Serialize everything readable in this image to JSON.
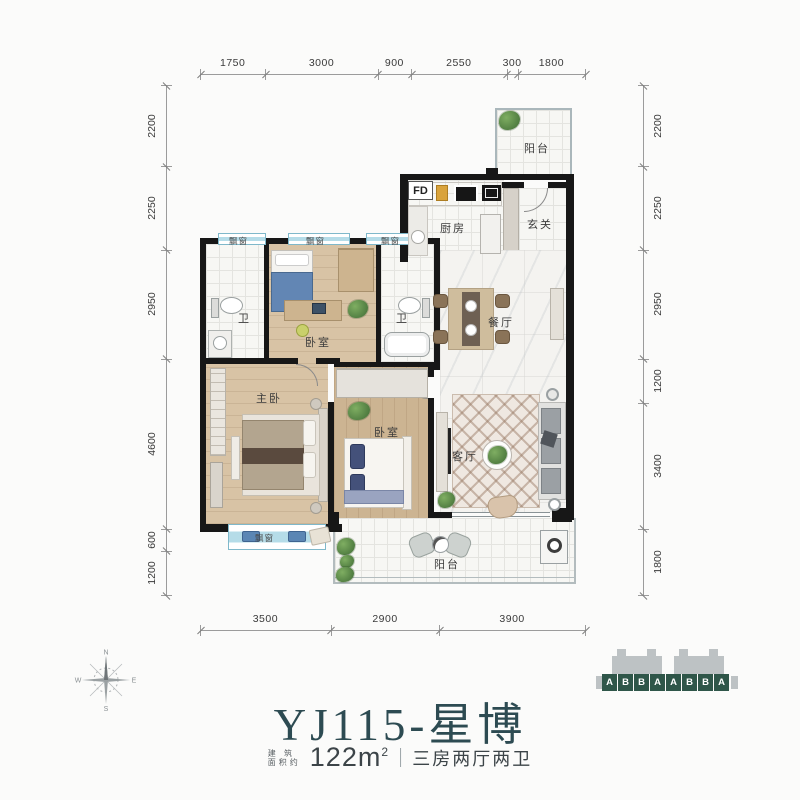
{
  "title_block": {
    "title": "YJ115-星博",
    "area_label_top": "建 筑",
    "area_label_bottom": "面积约",
    "area_value": "122m",
    "area_superscript": "2",
    "separator": "|",
    "spec": "三房两厅两卫"
  },
  "floorplan": {
    "rooms": {
      "balcony_top": "阳台",
      "flue": "FD",
      "kitchen": "厨房",
      "entry": "玄关",
      "dining": "餐厅",
      "bath_left": "卫",
      "bedroom_top": "卧室",
      "bath_right": "卫",
      "master": "主卧",
      "bedroom_second": "卧室",
      "living": "客厅",
      "balcony_bottom": "阳台",
      "bay1": "飘窗",
      "bay2": "飘窗",
      "bay3": "飘窗",
      "bay_master": "飘窗"
    }
  },
  "dimensions": {
    "top": {
      "segments": [
        1750,
        3000,
        900,
        2550,
        300,
        1800
      ]
    },
    "bottom": {
      "segments": [
        3500,
        2900,
        3900
      ]
    },
    "left": {
      "segments": [
        2200,
        2250,
        2950,
        4600,
        600,
        1200
      ]
    },
    "right": {
      "segments": [
        2200,
        2250,
        2950,
        1200,
        3400,
        1800
      ]
    }
  },
  "compass": {
    "north": "N",
    "east": "E",
    "south": "S",
    "west": "W"
  },
  "building_key": {
    "units": [
      "A",
      "B",
      "B",
      "A",
      "A",
      "B",
      "B",
      "A"
    ]
  },
  "colors": {
    "accent_teal": "#2d4b52",
    "unit_block_green": "#2f5649",
    "wall_black": "#171717",
    "bay_window_blue": "#b5dce8",
    "wood_floor": "#d8c3a5",
    "wood_floor_dark": "#ccb492",
    "dimension_text": "#3a3a3a"
  }
}
